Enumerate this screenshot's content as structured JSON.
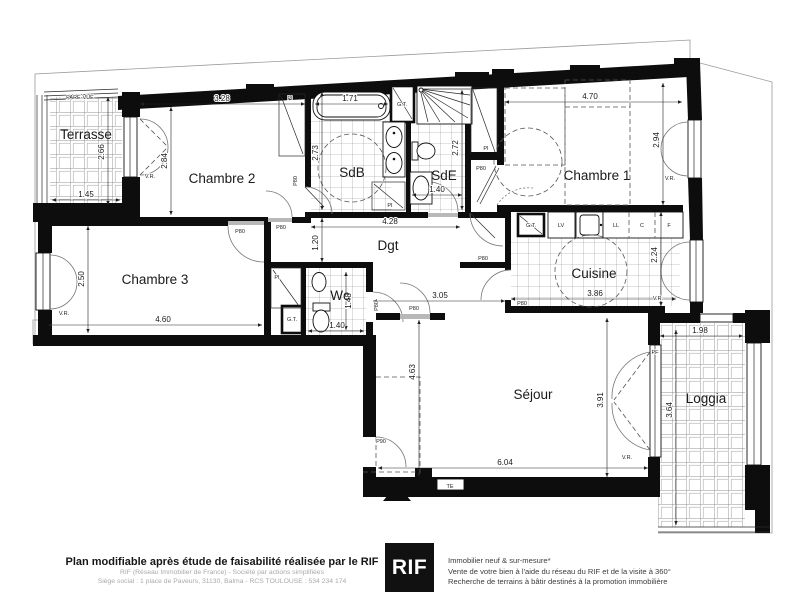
{
  "plan": {
    "rooms": {
      "terrasse": "Terrasse",
      "chambre2": "Chambre 2",
      "sdb": "SdB",
      "sde": "SdE",
      "chambre1": "Chambre 1",
      "chambre3": "Chambre 3",
      "wc": "Wc",
      "dgt": "Dgt",
      "cuisine": "Cuisine",
      "sejour": "Séjour",
      "loggia": "Loggia"
    },
    "dims": {
      "terrasse_h": "2.66",
      "terrasse_w": "1.45",
      "ch2_w": "3.28",
      "ch2_h": "2.84",
      "bathtub_w": "1.71",
      "sdb_h": "2.73",
      "sde_w": "1.40",
      "sde_h": "2.72",
      "ch1_w": "4.70",
      "ch1_h": "2.94",
      "dgt_w": "4.28",
      "dgt_h": "1.20",
      "ch3_w": "4.60",
      "ch3_h": "2.50",
      "wc_h": "1.48",
      "wc_w": "1.40",
      "entry_w": "3.05",
      "cuisine_w": "3.86",
      "cuisine_h": "2.24",
      "sejour_h_left": "4.63",
      "sejour_h_right": "3.91",
      "sejour_w": "6.04",
      "loggia_w": "1.98",
      "loggia_h": "3.64"
    },
    "tags": {
      "pare_vue": "PARE-VUE",
      "vr": "V.R.",
      "pi": "PI",
      "gt": "G.T.",
      "te": "TE",
      "lv": "LV",
      "ll": "LL",
      "c": "C",
      "f": "F",
      "pf": "PF",
      "p80": "P80",
      "p90": "P90"
    }
  },
  "footer": {
    "disclaimer": "Plan modifiable après étude de faisabilité réalisée par le RIF",
    "company_line1": "RIF (Réseau Immobilier de France) - Société par actions simplifiées",
    "company_line2": "Siège social : 1 place de Paveurs, 31130, Balma - RCS TOULOUSE : 534 234 174",
    "logo": "RIF",
    "services_line1": "Immobilier neuf & sur-mesure*",
    "services_line2": "Vente de votre bien à l'aide du réseau du RIF et de la visite à 360°",
    "services_line3": "Recherche de terrains à bâtir destinés à la promotion immobilière"
  }
}
